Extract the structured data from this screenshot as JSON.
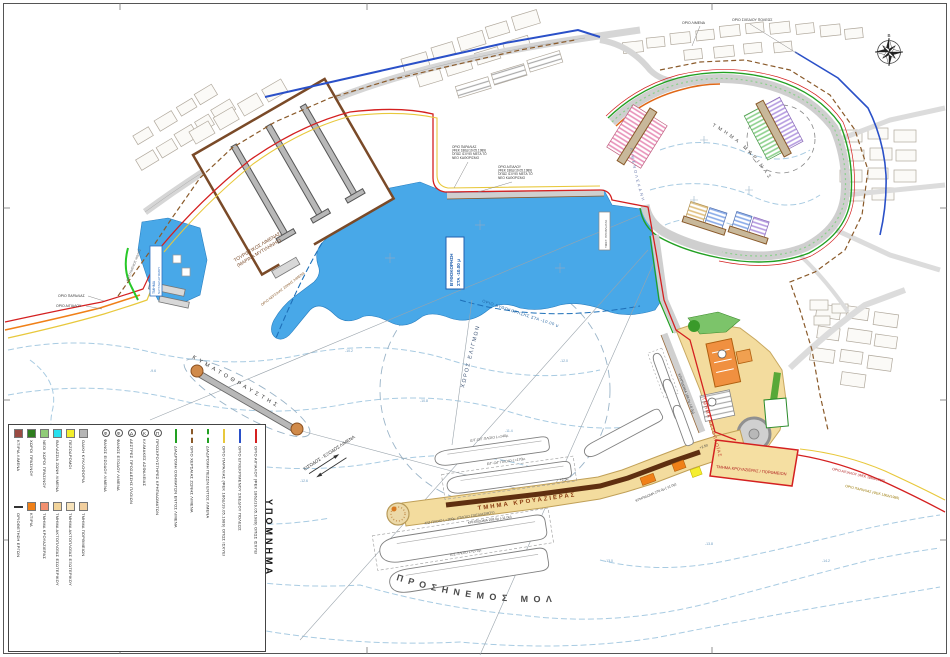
{
  "legend": {
    "title": "ΥΠΟΜΝΗΜΑ",
    "zones": [
      {
        "color": "#9a4a42",
        "label": "ΚΤΙΡΙΑ ΛΙΜΕΝΑ"
      },
      {
        "color": "#2e7d1e",
        "label": "ΧΩΡΟΙ ΠΡΑΣΙΝΟΥ"
      },
      {
        "color": "#90cc78",
        "label": "ΝΕΟΙ ΧΩΡΟΙ ΠΡΑΣΙΝΟΥ"
      },
      {
        "color": "#28e0ee",
        "label": "ΘΑΛΑΣΣΙΑ ΖΩΝΗ ΛΙΜΕΝΑ"
      },
      {
        "color": "#f2ee2c",
        "label": "ΠΕΖΟΔΡΟΜΟΙ"
      },
      {
        "color": "#b5b5b5",
        "label": "ΟΔΙΚΗ ΚΥΚΛΟΦΟΡΙΑ"
      }
    ],
    "sections": [
      {
        "type": "line",
        "color": "#333333",
        "label": "ΟΡΙΟΘΕΤΗΣΗ ΕΡΓΩΝ"
      },
      {
        "color": "#f08018",
        "label": "ΚΤΙΡΙΑ"
      },
      {
        "color": "#f29070",
        "label": "ΤΜΗΜΑ ΚΡΟΥΑΖΙΕΡΑΣ"
      },
      {
        "color": "#f2d49b",
        "label": "ΤΜΗΜΑ ΑΚΤΟΠΛΟΪΑΣ ΕΣΩΤΕΡΙΚΟΥ"
      },
      {
        "color": "#f7e3bb",
        "label": "ΤΜΗΜΑ ΑΚΤΟΠΛΟΪΑΣ ΕΞΩΤΕΡΙΚΟΥ"
      },
      {
        "color": "#f2cf9e",
        "label": "ΤΜΗΜΑ ΠΟΡΘΜΕΙΩΝ"
      }
    ],
    "symbols": [
      {
        "mark": "Φ",
        "label": "ΦΑΝΟΣ ΕΙΣΟΔΟΥ ΛΙΜΕΝΑ"
      },
      {
        "mark": "Φ",
        "label": "ΦΑΝΟΣ ΕΞΟΔΟΥ ΛΙΜΕΝΑ"
      },
      {
        "mark": "Δ",
        "label": "ΔΕΣΤΡΕΣ ΠΡΟΣΔΕΣΗΣ ΠΛΟΙΩΝ"
      },
      {
        "mark": "Κ",
        "label": "ΚΛΙΜΑΚΕΣ ΑΣΦΑΛΕΙΑΣ"
      },
      {
        "mark": "Π",
        "label": "ΠΡΟΣΚΡΟΥΣΤΗΡΕΣ ΚΡΗΠΙΔΩΜΑΤΩΝ"
      }
    ],
    "lines": [
      {
        "color": "#22a022",
        "style": "solid",
        "arrows": true,
        "label": "ΔΙΑΔΡΟΜΗ ΟΧΗΜΑΤΩΝ ΕΝΤΟΣ ΛΙΜΕΝΑ"
      },
      {
        "color": "#8a5a2a",
        "style": "dashed",
        "arrows": false,
        "label": "ΟΡΙΟ ΧΕΡΣΑΙΑΣ ΖΩΝΗΣ ΛΙΜΕΝΑ"
      },
      {
        "color": "#22a022",
        "style": "dashed",
        "arrows": true,
        "label": "ΔΙΑΔΡΟΜΗ ΠΕΖΩΝ ΕΝΤΟΣ ΛΙΜΕΝΑ"
      },
      {
        "color": "#e8c83c",
        "style": "solid",
        "arrows": false,
        "label": "ΟΡΙΟ ΠΑΡΑΛΙΑΣ (ΦΕΚ 186Δ/19.05.1989) ΟΠΩΣ ΙΣΧΥΕΙ"
      },
      {
        "color": "#2a50c8",
        "style": "solid",
        "arrows": false,
        "label": "ΟΡΙΟ ΕΓΚΕΚΡΙΜΕΝΟΥ ΣΧΕΔΙΟΥ ΠΟΛΕΩΣ"
      },
      {
        "color": "#d42020",
        "style": "solid",
        "arrows": false,
        "label": "ΟΡΙΟ ΑΙΓΙΑΛΟΥ (ΦΕΚ 186Δ/19.05.1989) ΟΠΩΣ ΙΣΧΥΕΙ"
      }
    ]
  },
  "map": {
    "compass_north": "Β",
    "labels": {
      "dredge_box_line1": "ΒΥΘΟΚΟΡΗΣΗ",
      "dredge_box_line2": "ΣΤΑ -10.00 μ",
      "dredge_limit": "ΟΡΙΟ ΒΥΘΟΚΟΡΗΣΗΣ ΣΤΑ -10.00 μ",
      "maneuvering_area": "ΧΩΡΟΣ ΕΛΙΓΜΩΝ",
      "breakwater": "ΚΥΜΑΤΟΘΡΑΥΣΤΗΣ",
      "entrance_exit": "ΕΙΣΟΔΟΣ - ΕΞΟΔΟΣ ΛΙΜΕΝΑ",
      "windward_mole": "ΠΡΟΣΗΝΕΜΟΣ ΜΟΛΟΣ",
      "cruise_section": "ΤΜΗΜΑ ΚΡΟΥΑΖΙΕΡΑΣ",
      "cruise_ferry_zone": "ΤΜΗΜΑ ΚΡΟΥΑΖΙΕΡΑΣ / ΠΟΡΘΜΕΙΩΝ",
      "coastal_section": "ΤΜΗΜΑ ΑΚΤΟΠΛΟΪΑΣ",
      "marina_section": "ΤΜΗΜΑ ΜΑΡΙΝΑΣ",
      "basin": "ΛΙΜΕΝΟΛΕΚΑΝΗ",
      "tourist_port_line1": "ΤΟΥΡΙΣΤΙΚΟΣ ΛΙΜΕΝΑΣ",
      "tourist_port_line2": "(ΜΑΡΙΝΑ ΜΥΤΙΛΗΝΗΣ)",
      "nautical_line1": "ΤΜΗΜΑ",
      "nautical_line2": "ΝΑΥΤΑΘΛΗΤΙΣΜΟΥ",
      "shore_paralia": "ΟΡΙΟ ΠΑΡΑΛΙΑΣ",
      "shore_aigialos": "ΟΡΙΟ ΑΙΓΙΑΛΟΥ",
      "paralia_note": [
        "ΟΡΙΟ ΠΑΡΑΛΙΑΣ",
        "(ΦΕΚ 186Δ/19.05.1989)",
        "ΟΠΩΣ ΙΣΧΥΕΙ ΜΕΤΑ ΤΟ",
        "ΝΕΟ ΚΑΘΟΡΙΣΜΟ"
      ],
      "aigialos_note": [
        "ΟΡΙΟ ΑΙΓΙΑΛΟΥ",
        "(ΦΕΚ 186Δ/19.05.1989)",
        "ΟΠΩΣ ΙΣΧΥΕΙ ΜΕΤΑ ΤΟ",
        "ΝΕΟ ΚΑΘΟΡΙΣΜΟ"
      ],
      "aigialos_se": "ΟΡΙΟ ΑΙΓΙΑΛΟΥ (ΦΕΚ 186Δ/1989)",
      "paralia_se": "ΟΡΙΟ ΠΑΡΑΛΙΑΣ (ΦΕΚ 186Δ/1989)",
      "hzl": "ΟΡΙΟ ΧΕΡΣΑΙΑΣ ΖΩΝΗΣ ΛΙΜΕΝΑ",
      "city_plan": "ΟΡΙΟ ΣΧΕΔΙΟΥ ΠΟΛΕΩΣ",
      "port_limit": "ΟΡΙΟ ΛΙΜΕΝΑ",
      "existing_jetty": "ΥΦΙΣΤ. ΠΡΟΒΛΗΤΑΣ",
      "existing_mole": "ΥΦΙΣΤΑΜΕΝΟΣ ΜΩΛΟΣ"
    },
    "ships": [
      "Ε/Γ-Ο/Γ ΠΛΟΙΟ L=170μ.",
      "Ε/Γ-Ο/Γ ΠΛΟΙΟ L=140μ.",
      "Κ/Ζ ΠΛΟΙΟ L=300μ. (ΠΛΟΙΟ ΣΧΕΔΙΑΣΜΟΥ)",
      "Κ/Ζ ΠΛΟΙΟ L=270μ."
    ],
    "dims": [
      "ΚΡΗΠΙΔΩΜΑ 258.0μ (-11.0μ)",
      "ΚΡΗΠΙΔΩΜΑ 270.0μ (-11.0μ)",
      "+2.50",
      "+2.50",
      "ΚΡΗΠΙΔΩΜΑ 186.0μ (-8.0μ)"
    ],
    "soundings": [
      "-9.6",
      "-10.2",
      "-10.8",
      "-11.4",
      "-12.0",
      "-12.6",
      "-13.0",
      "-13.8",
      "-14.2",
      "-12.8"
    ]
  },
  "colors": {
    "water": "#48a8e8",
    "quay_tan": "#f3dc9e",
    "road_gray": "#cfcfcf",
    "boundary_red": "#d42020",
    "boundary_yellow": "#e8c83c",
    "city_plan_blue": "#2a50c8",
    "route_green": "#22a022",
    "land_zone_brown": "#8a5a2a"
  }
}
